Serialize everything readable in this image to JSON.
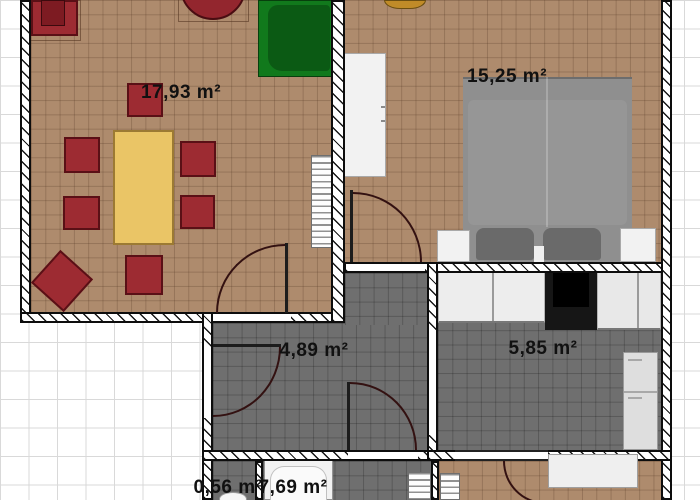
{
  "rooms": [
    {
      "id": "living-room",
      "area_label": "17,93 m²"
    },
    {
      "id": "bedroom",
      "area_label": "15,25 m²"
    },
    {
      "id": "hallway",
      "area_label": "4,89 m²"
    },
    {
      "id": "kitchen",
      "area_label": "5,85 m²"
    },
    {
      "id": "closet",
      "area_label": "0,56 m²"
    },
    {
      "id": "bathroom",
      "area_label": "7,69 m²"
    }
  ],
  "colors": {
    "floor_wood": "#ae8b6d",
    "floor_tile": "#6f6f6f",
    "wall": "#0d0d0d",
    "furniture_red": "#9d2b32",
    "furniture_red_dark": "#5a1016",
    "table_yellow": "#eac566",
    "table_yellow_dark": "#9c7a33",
    "sofa_green": "#11791c",
    "sofa_green_dark": "#0b5a14",
    "bed_gray": "#8f8f8f",
    "pillow_gray": "#6a6a6a",
    "furniture_white": "#f2f2f2",
    "stove_black": "#161616",
    "decor_gold": "#c08b28",
    "outside_grid": "#d9d9d9",
    "label_text": "#111111"
  }
}
